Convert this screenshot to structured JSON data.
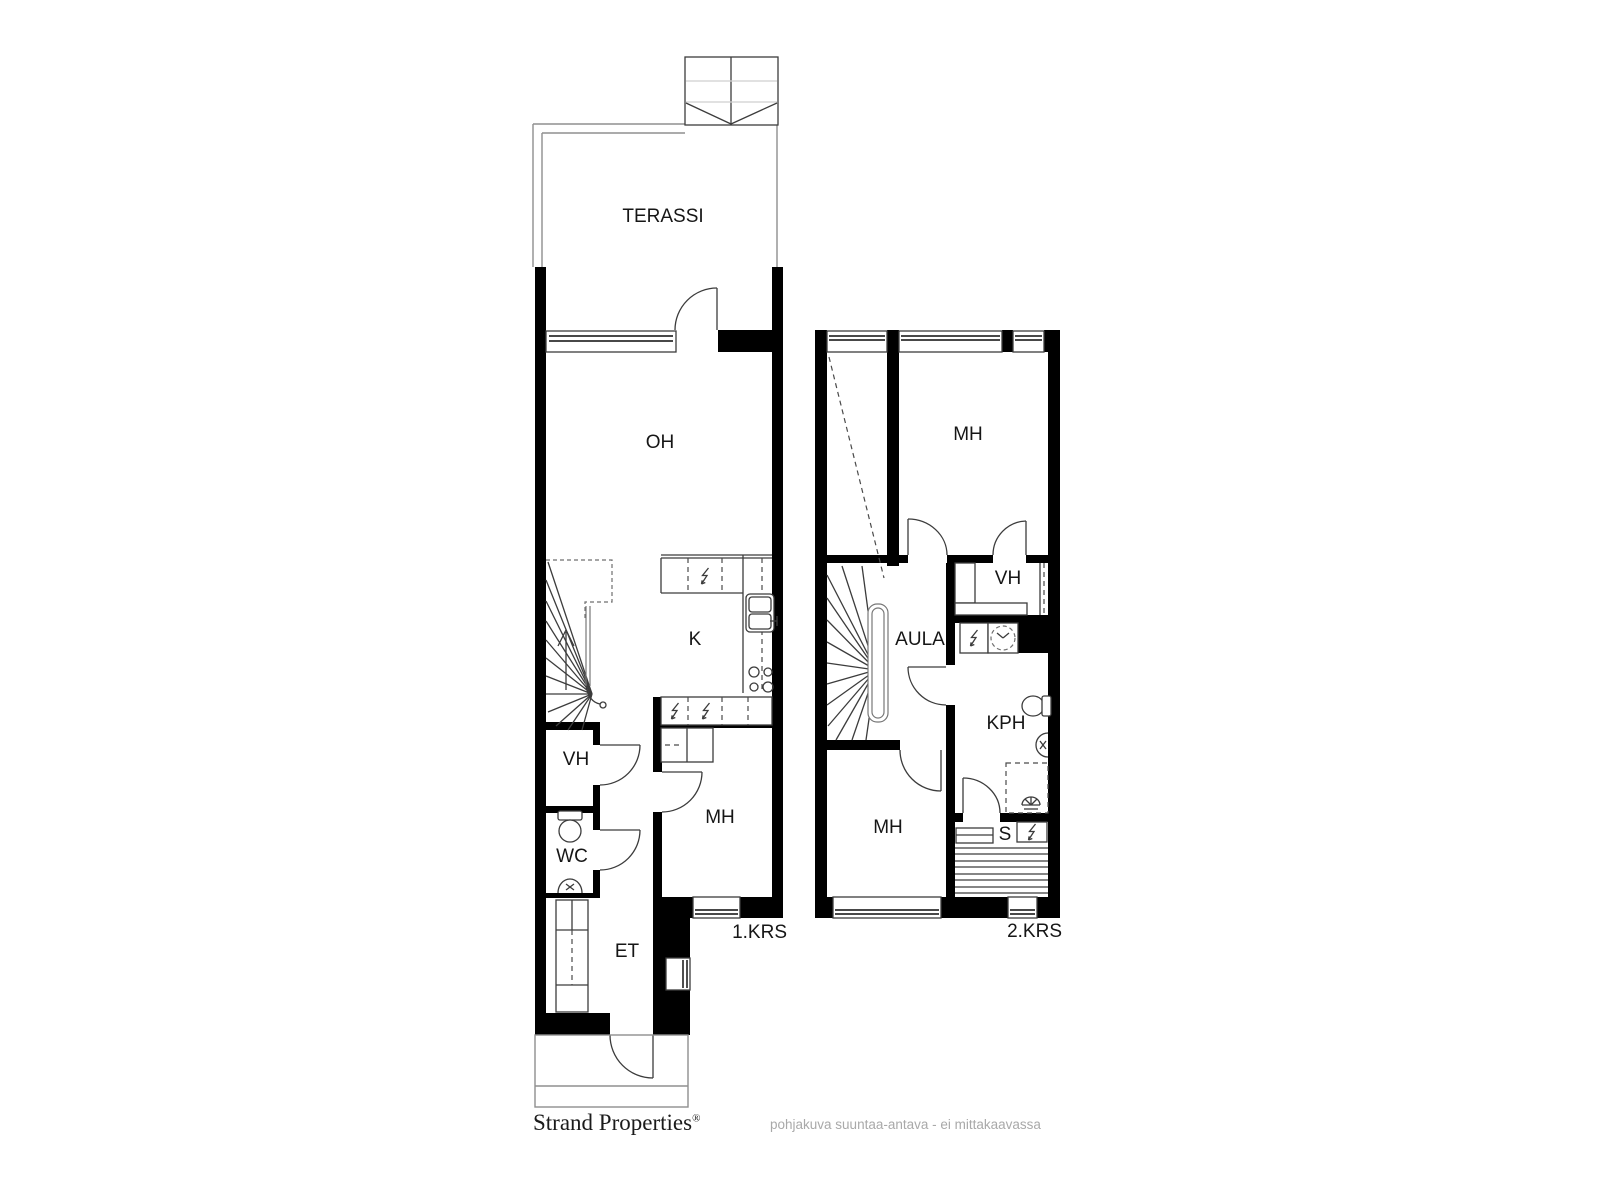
{
  "floor1": {
    "floor_label": "1.KRS",
    "rooms": {
      "terassi": "TERASSI",
      "oh": "OH",
      "k": "K",
      "vh": "VH",
      "wc": "WC",
      "mh": "MH",
      "et": "ET"
    }
  },
  "floor2": {
    "floor_label": "2.KRS",
    "rooms": {
      "mh_top": "MH",
      "vh": "VH",
      "aula": "AULA",
      "kph": "KPH",
      "mh_bottom": "MH",
      "s": "S"
    }
  },
  "footer": {
    "brand": "Strand Properties",
    "trademark": "®",
    "disclaimer": "pohjakuva suuntaa-antava - ei mittakaavassa"
  },
  "colors": {
    "wall": "#000000",
    "line": "#3c3c3c",
    "outline_gray": "#8f8f8f",
    "label": "#161616",
    "disclaimer_text": "#a9a9a9"
  }
}
